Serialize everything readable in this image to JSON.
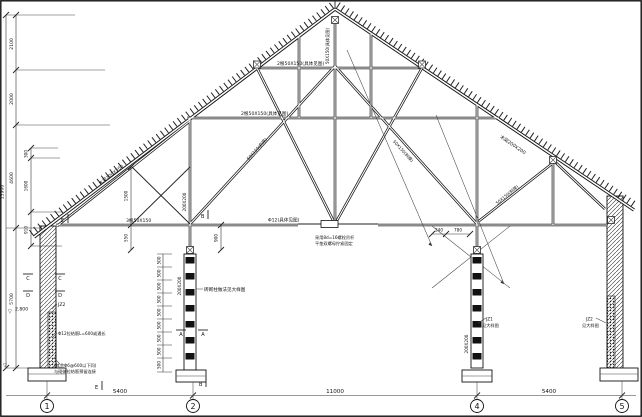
{
  "drawing": {
    "members": {
      "rafter_left": "木梁200X200",
      "rafter_right": "木梁200X200",
      "king_post": "50X150(具体见图)",
      "collar_upper": "2根50X150(具体见图)",
      "collar_lower": "2根50X150(具体见图)",
      "tie_beam": "3根50X150",
      "diag_left": "50X150(斜撑)",
      "diag_right": "50X150(斜撑)",
      "diag_right2": "50X150(斜撑)",
      "queen_post": "200X200",
      "rod": "Φ12(具体见图)",
      "rod_note1": "采用8d=16螺栓吊杆",
      "rod_note2": "平垫双螺母拧紧固定"
    },
    "columns": {
      "col2_size": "200X200",
      "col2_note": "砖砌柱做法见大样图",
      "col4_size": "200X200",
      "jz1_code": "JZ1",
      "jz1_ref": "见大样图",
      "jz2_code": "JZ2",
      "jz2_ref": "见大样图",
      "wall_mark": "JZ2"
    },
    "wall_notes": {
      "tie_bar": "Φ12拉结筋L=600或通长",
      "note1": "(其余Φ6@600以下同)",
      "note2": "与砌体拉结筋预留连接"
    },
    "sections": {
      "a": "A",
      "b": "B",
      "c": "C",
      "d": "D",
      "e": "E"
    },
    "levels": {
      "wall_level": "2.800",
      "datum": "▽"
    },
    "dimensions": {
      "total_height": "13900",
      "left_chain": [
        "2100",
        "2000",
        "4600",
        "5700"
      ],
      "inner_chain": [
        "300",
        "1600",
        "910"
      ],
      "queen_dim": "1500",
      "tie_dim_left": "550",
      "tie_dim_mid": "900",
      "col4_dims": [
        "240",
        "780"
      ],
      "col2_chain": [
        "500",
        "500",
        "500",
        "500",
        "500",
        "500",
        "500",
        "500",
        "500"
      ],
      "spans": [
        "5400",
        "11000",
        "5400"
      ]
    },
    "grid": {
      "bubbles": [
        "1",
        "2",
        "4",
        "5"
      ]
    }
  }
}
